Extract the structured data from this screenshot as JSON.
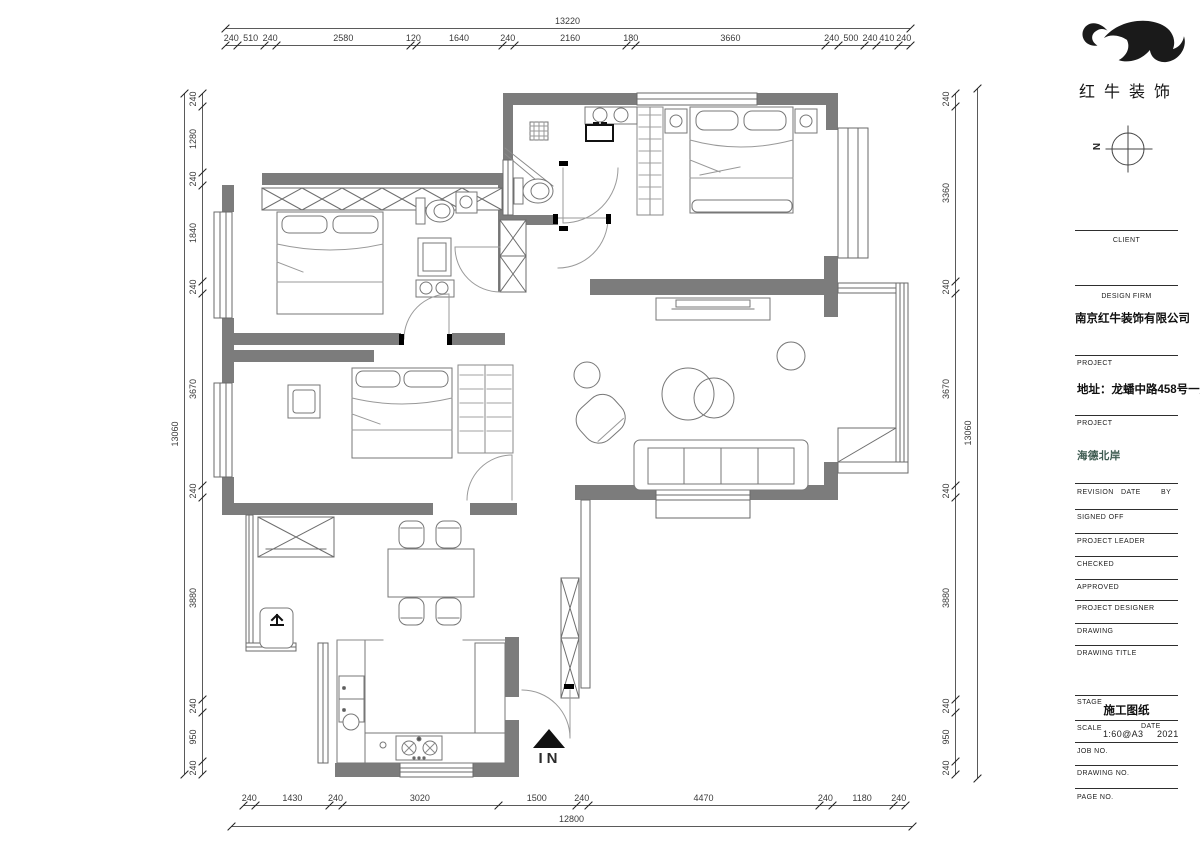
{
  "logo": {
    "brand_name": "红牛装饰"
  },
  "compass": {
    "north_label": "N"
  },
  "entrance": {
    "label": "IN"
  },
  "dimensions": {
    "top": {
      "total": "13220",
      "segments": [
        "240",
        "510",
        "240",
        "2580",
        "120",
        "1640",
        "240",
        "2160",
        "180",
        "3660",
        "240",
        "500",
        "240",
        "410",
        "240"
      ]
    },
    "bottom": {
      "total": "12800",
      "segments": [
        "240",
        "1430",
        "240",
        "3020",
        "1500",
        "240",
        "4470",
        "240",
        "1180",
        "240"
      ]
    },
    "left": {
      "total": "13060",
      "segments": [
        "240",
        "1280",
        "240",
        "1840",
        "240",
        "3670",
        "240",
        "3880",
        "240",
        "950",
        "240"
      ]
    },
    "right": {
      "total": "13060",
      "segments": [
        "240",
        "3360",
        "240",
        "3670",
        "240",
        "3880",
        "240",
        "950",
        "240"
      ]
    }
  },
  "title_block": {
    "client_label": "CLIENT",
    "design_firm_label": "DESIGN FIRM",
    "design_firm_value": "南京红牛装饰有限公司",
    "project1_label": "PROJECT",
    "project1_value": "地址：龙蟠中路458号一层",
    "project2_label": "PROJECT",
    "project2_value": "海德北岸",
    "revision_label": "REVISION",
    "date_label": "DATE",
    "by_label": "BY",
    "signed_off_label": "SIGNED OFF",
    "project_leader_label": "PROJECT LEADER",
    "checked_label": "CHECKED",
    "approved_label": "APPROVED",
    "project_designer_label": "PROJECT DESIGNER",
    "drawing_label": "DRAWING",
    "drawing_title_label": "DRAWING TITLE",
    "stage_label": "STAGE",
    "stage_value": "施工图纸",
    "scale_label": "SCALE",
    "scale_value": "1:60@A3",
    "date2_label": "DATE",
    "date_value": "2021",
    "job_no_label": "JOB NO.",
    "drawing_no_label": "DRAWING NO.",
    "page_no_label": "PAGE NO."
  }
}
